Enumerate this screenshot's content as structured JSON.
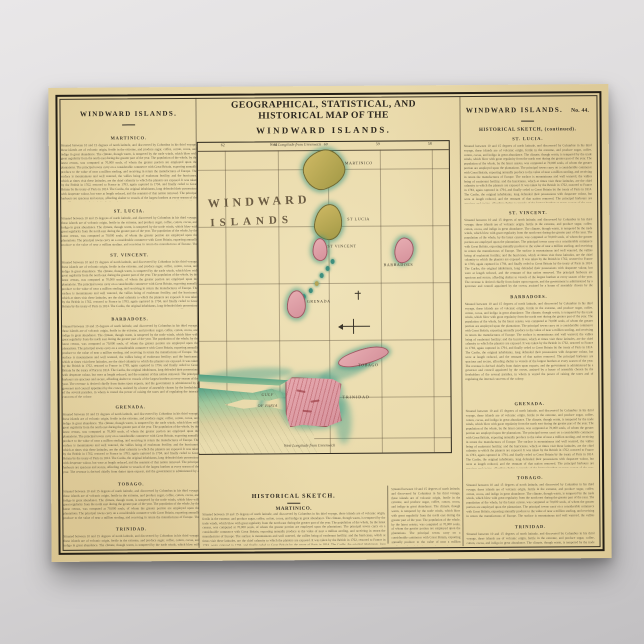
{
  "poster": {
    "title_line1": "GEOGRAPHICAL, STATISTICAL, AND HISTORICAL MAP OF THE",
    "title_line2": "WINDWARD ISLANDS.",
    "left_column": {
      "header": "WINDWARD ISLANDS.",
      "sections": [
        {
          "title": "MARTINICO."
        },
        {
          "title": "ST. LUCIA."
        },
        {
          "title": "ST. VINCENT."
        },
        {
          "title": "BARBADOES."
        },
        {
          "title": "GRENADA."
        },
        {
          "title": "TOBAGO."
        },
        {
          "title": "TRINIDAD."
        }
      ]
    },
    "right_column": {
      "header": "WINDWARD ISLANDS.",
      "number": "No. 44.",
      "subheader": "HISTORICAL SKETCH, (continued).",
      "sections": [
        {
          "title": "ST. LUCIA."
        },
        {
          "title": "ST. VINCENT."
        },
        {
          "title": "BARBADOES."
        },
        {
          "title": "GRENADA."
        },
        {
          "title": "TOBAGO."
        },
        {
          "title": "TRINIDAD."
        }
      ]
    },
    "bottom_center": {
      "header": "HISTORICAL SKETCH.",
      "subheader": "MARTINICO."
    },
    "map": {
      "big_label_line1": "WINDWARD",
      "big_label_line2": "ISLANDS",
      "islands": [
        {
          "label": "MARTINICO"
        },
        {
          "label": "ST LUCIA"
        },
        {
          "label": "ST VINCENT"
        },
        {
          "label": "BARBADOES"
        },
        {
          "label": "GRENADA"
        },
        {
          "label": "TOBAGO"
        },
        {
          "label": "TRINIDAD"
        }
      ],
      "sea_labels": {
        "gulf_line1": "GULF",
        "gulf_line2": "OF PARIA"
      },
      "edge_label": "West Longitude from Greenwich",
      "ticks": [
        "62",
        "61",
        "60",
        "59",
        "58"
      ],
      "colors": {
        "paper": "#ead9a9",
        "sea_tint": "#4fa08c",
        "island_olive": "#c3ac58",
        "island_pink": "#dfa0a6",
        "coast_green": "#55a286",
        "ink": "#3c362b"
      }
    },
    "filler": "Situated between 10 and 15 degrees of north latitude, and discovered by Columbus in his third voyage, these islands are of volcanic origin, fertile in the extreme, and produce sugar, coffee, cotton, cocoa, and indigo in great abundance. The climate, though warm, is tempered by the trade winds, which blow with great regularity from the north east during the greater part of the year. The population of the whole, by the latest census, was computed at 70,000 souls, of whom the greater portion are employed upon the plantations. The principal towns carry on a considerable commerce with Great Britain, exporting annually produce to the value of near a million sterling, and receiving in return the manufactures of Europe. The surface is mountainous and well watered, the vallies being of exuberant fertility; and the hurricanes, which at times visit these latitudes, are the chief calamity to which the planters are exposed. It was taken by the British in 1762, restored to France in 1783, again captured in 1794, and finally ceded to Great Britain by the treaty of Paris in 1814. The Caribs, the original inhabitants, long defended their possessions with desperate valour, but were at length reduced, and the remnant of that nation removed. The principal harbours are spacious and secure, affording shelter to vessels of the largest burthen at every season of the year. The revenue is derived chiefly from duties upon exports, and the government is administered by a governor and council appointed by the crown, assisted by a house of assembly chosen by the freeholders of the several parishes, in whom is vested the power of raising the taxes and of regulating the internal concerns of the colony."
  }
}
